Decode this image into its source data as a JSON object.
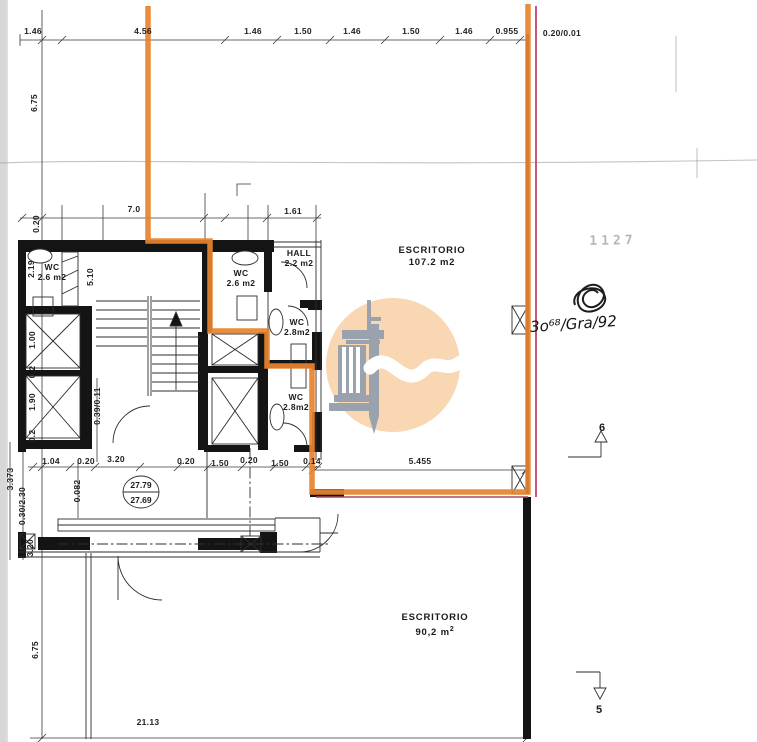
{
  "colors": {
    "ink": "#141414",
    "highlight_orange": "#e8832f",
    "highlight_crimson": "#c9567f",
    "underline_red": "#a94a5e",
    "watermark_peach": "#f8d7b2",
    "watermark_gray": "#9aa3ad",
    "scan_edge_gray": "#d7d7d7"
  },
  "rooms": {
    "wc_left": {
      "name": "WC",
      "area": "2.6 m2"
    },
    "wc_mid": {
      "name": "WC",
      "area": "2.6 m2"
    },
    "hall": {
      "name": "HALL",
      "area": "2.2 m2"
    },
    "wc_upper_right": {
      "name": "WC",
      "area": "2.8m2"
    },
    "wc_lower_right": {
      "name": "WC",
      "area": "2.8m2"
    },
    "office_upper": {
      "name": "ESCRITORIO",
      "area": "107.2 m2"
    },
    "office_lower": {
      "name": "ESCRITORIO",
      "area": "90,2 m",
      "area_exp": "2"
    }
  },
  "levels": {
    "upper": "27.79",
    "lower": "27.69"
  },
  "section_markers": {
    "up_label": "6",
    "down_label": "5"
  },
  "annotations": {
    "faded_number": "1127",
    "handwritten_ref": "3o⁶⁸/Gra/92"
  },
  "dimension_labels": [
    {
      "text": "1.46",
      "x": 33,
      "y": 31,
      "rot": 0
    },
    {
      "text": "4.56",
      "x": 143,
      "y": 31,
      "rot": 0
    },
    {
      "text": "1.46",
      "x": 253,
      "y": 31,
      "rot": 0
    },
    {
      "text": "1.50",
      "x": 303,
      "y": 31,
      "rot": 0
    },
    {
      "text": "1.46",
      "x": 352,
      "y": 31,
      "rot": 0
    },
    {
      "text": "1.50",
      "x": 411,
      "y": 31,
      "rot": 0
    },
    {
      "text": "1.46",
      "x": 464,
      "y": 31,
      "rot": 0
    },
    {
      "text": "0.955",
      "x": 507,
      "y": 31,
      "rot": 0
    },
    {
      "text": "0.20/0.01",
      "x": 562,
      "y": 33,
      "rot": 0
    },
    {
      "text": "7.0",
      "x": 134,
      "y": 209,
      "rot": 0
    },
    {
      "text": "1.61",
      "x": 293,
      "y": 211,
      "rot": 0
    },
    {
      "text": "6.75",
      "x": 34,
      "y": 103,
      "rot": -90
    },
    {
      "text": "0.20",
      "x": 36,
      "y": 224,
      "rot": -90
    },
    {
      "text": "2.19",
      "x": 31,
      "y": 269,
      "rot": -90
    },
    {
      "text": "5.10",
      "x": 90,
      "y": 277,
      "rot": -90
    },
    {
      "text": "1.00",
      "x": 32,
      "y": 340,
      "rot": -90
    },
    {
      "text": "0.2",
      "x": 32,
      "y": 372,
      "rot": -90
    },
    {
      "text": "1.90",
      "x": 32,
      "y": 402,
      "rot": -90
    },
    {
      "text": "0.2",
      "x": 32,
      "y": 436,
      "rot": -90
    },
    {
      "text": "0.39/0.11",
      "x": 97,
      "y": 406,
      "rot": -90
    },
    {
      "text": "0.082",
      "x": 77,
      "y": 491,
      "rot": -90
    },
    {
      "text": "3.373",
      "x": 10,
      "y": 479,
      "rot": -90
    },
    {
      "text": "0.30/2.30",
      "x": 22,
      "y": 506,
      "rot": -90
    },
    {
      "text": "3.20",
      "x": 30,
      "y": 548,
      "rot": -90
    },
    {
      "text": "6.75",
      "x": 35,
      "y": 650,
      "rot": -90
    },
    {
      "text": "1.04",
      "x": 51,
      "y": 461,
      "rot": 0
    },
    {
      "text": "0.20",
      "x": 86,
      "y": 461,
      "rot": 0
    },
    {
      "text": "3.20",
      "x": 116,
      "y": 459,
      "rot": 0
    },
    {
      "text": "0.20",
      "x": 186,
      "y": 461,
      "rot": 0
    },
    {
      "text": "1.50",
      "x": 220,
      "y": 463,
      "rot": 0
    },
    {
      "text": "0.20",
      "x": 249,
      "y": 460,
      "rot": 0
    },
    {
      "text": "1.50",
      "x": 280,
      "y": 463,
      "rot": 0
    },
    {
      "text": "0.14",
      "x": 312,
      "y": 461,
      "rot": 0
    },
    {
      "text": "5.455",
      "x": 420,
      "y": 461,
      "rot": 0
    },
    {
      "text": "21.13",
      "x": 148,
      "y": 722,
      "rot": 0
    }
  ]
}
